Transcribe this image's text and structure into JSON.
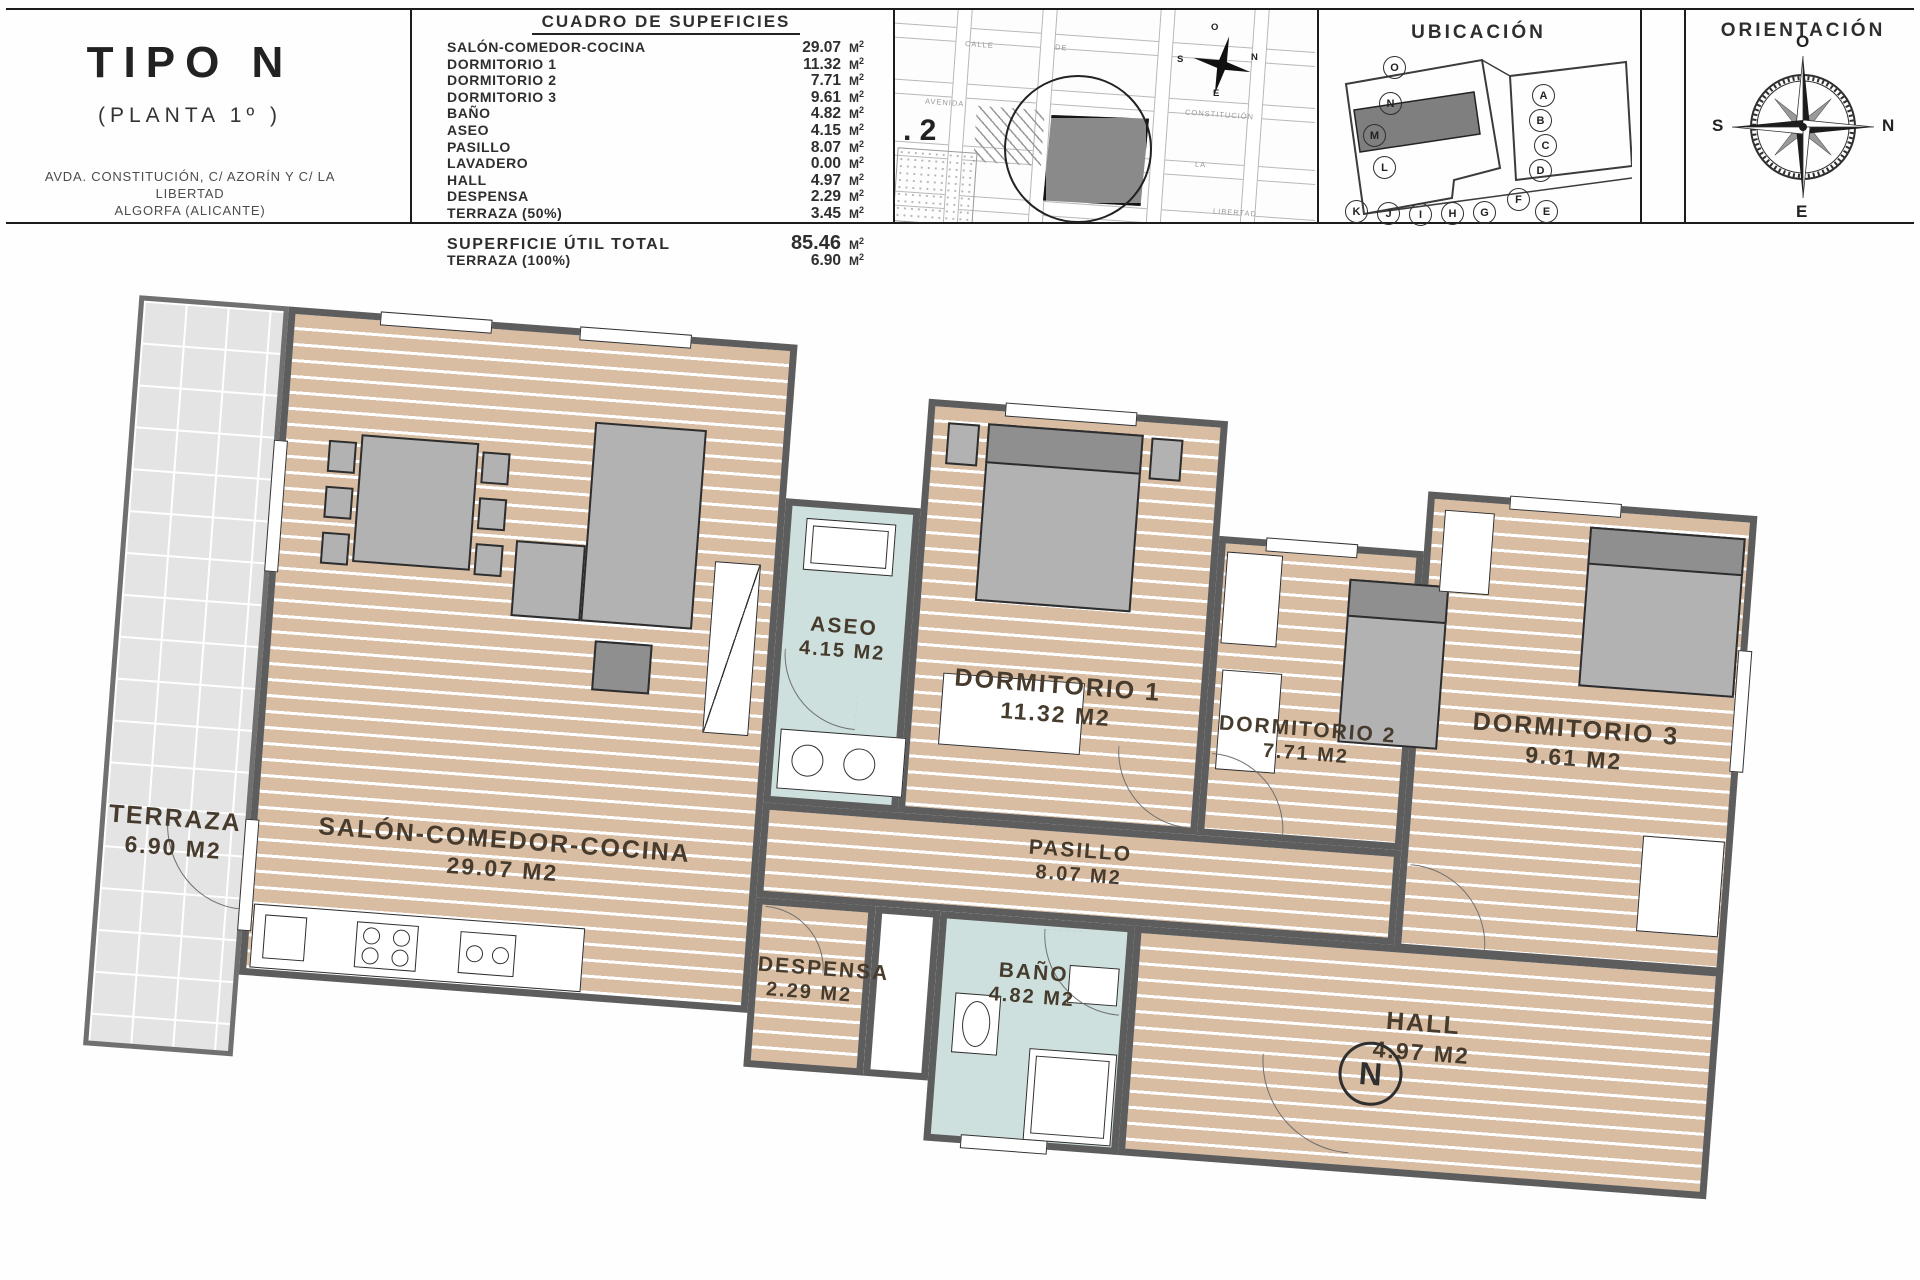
{
  "header": {
    "title_block": {
      "title": "TIPO N",
      "subtitle": "(PLANTA 1º )",
      "address1": "AVDA. CONSTITUCIÓN, C/ AZORÍN Y C/ LA LIBERTAD",
      "address2": "ALGORFA (ALICANTE)"
    },
    "areas_table": {
      "title": "CUADRO DE SUPEFICIES",
      "unit": "M",
      "unit_sup": "2",
      "rows": [
        {
          "label": "SALÓN-COMEDOR-COCINA",
          "value": "29.07"
        },
        {
          "label": "DORMITORIO 1",
          "value": "11.32"
        },
        {
          "label": "DORMITORIO 2",
          "value": "7.71"
        },
        {
          "label": "DORMITORIO 3",
          "value": "9.61"
        },
        {
          "label": "BAÑO",
          "value": "4.82"
        },
        {
          "label": "ASEO",
          "value": "4.15"
        },
        {
          "label": "PASILLO",
          "value": "8.07"
        },
        {
          "label": "LAVADERO",
          "value": "0.00"
        },
        {
          "label": "HALL",
          "value": "4.97"
        },
        {
          "label": "DESPENSA",
          "value": "2.29"
        },
        {
          "label": "TERRAZA (50%)",
          "value": "3.45"
        }
      ],
      "totals": [
        {
          "label": "SUPERFICIE ÚTIL TOTAL",
          "value": "85.46"
        },
        {
          "label": "TERRAZA (100%)",
          "value": "6.90"
        }
      ]
    },
    "site_map": {
      "plot_label": ". 2",
      "street_names": [
        "CALLE",
        "DE",
        "AVENIDA",
        "LA",
        "CONSTITUCIÓN",
        "LIBERTAD"
      ],
      "compass": {
        "top": "O",
        "right": "N",
        "bottom": "E",
        "left": "S"
      }
    },
    "ubicacion": {
      "title": "UBICACIÓN",
      "highlighted_unit": "N",
      "units": [
        "O",
        "N",
        "M",
        "L",
        "A",
        "B",
        "C",
        "D",
        "F",
        "E",
        "K",
        "J",
        "I",
        "H",
        "G"
      ]
    },
    "orientacion": {
      "title": "ORIENTACIÓN",
      "compass": {
        "top": "O",
        "right": "N",
        "bottom": "E",
        "left": "S"
      }
    }
  },
  "floor_plan": {
    "rooms": [
      {
        "name": "TERRAZA",
        "area": "6.90 M2"
      },
      {
        "name": "SALÓN-COMEDOR-COCINA",
        "area": "29.07 M2"
      },
      {
        "name": "ASEO",
        "area": "4.15 M2"
      },
      {
        "name": "DORMITORIO 1",
        "area": "11.32 M2"
      },
      {
        "name": "DORMITORIO 2",
        "area": "7.71 M2"
      },
      {
        "name": "DORMITORIO 3",
        "area": "9.61 M2"
      },
      {
        "name": "PASILLO",
        "area": "8.07 M2"
      },
      {
        "name": "DESPENSA",
        "area": "2.29 M2"
      },
      {
        "name": "BAÑO",
        "area": "4.82 M2"
      },
      {
        "name": "HALL",
        "area": "4.97 M2"
      }
    ],
    "unit_marker": "N"
  },
  "colors": {
    "wood": "#d9bda2",
    "tile": "#e4e4e4",
    "wet": "#cde0dd",
    "wall": "#5d5d5d",
    "ink": "#463b2c"
  }
}
